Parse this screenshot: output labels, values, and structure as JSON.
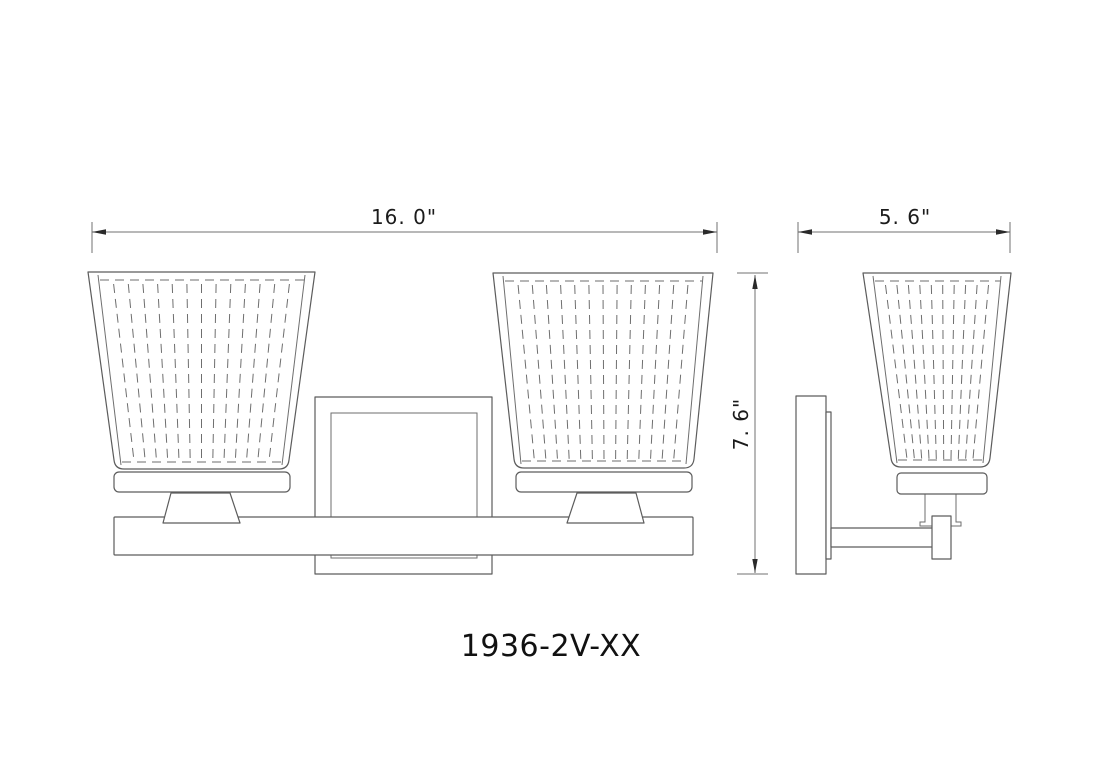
{
  "drawing": {
    "model_number": "1936-2V-XX",
    "dimensions": {
      "front_width": "16. 0\"",
      "fixture_height": "7. 6\"",
      "side_depth": "5. 6\""
    },
    "colors": {
      "line": "#5c5c5c",
      "dimension_line": "#707070",
      "text": "#1b1b1b",
      "background": "#ffffff"
    }
  }
}
